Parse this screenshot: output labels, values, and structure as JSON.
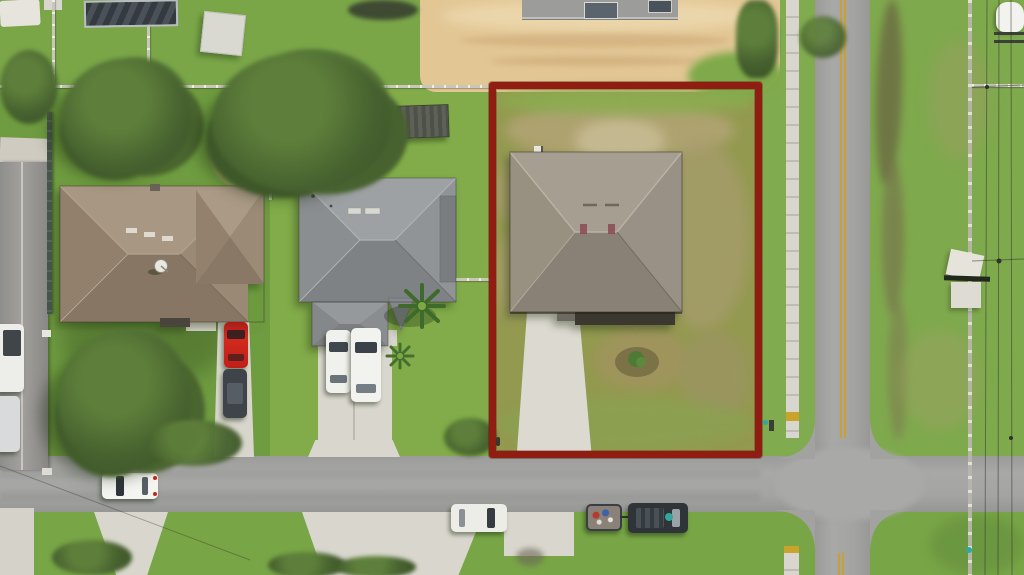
{
  "meta": {
    "image_type": "aerial-drone-photograph",
    "subject": "residential lot outlined for real estate listing",
    "width_px": 1024,
    "height_px": 575,
    "visible_text": "none"
  },
  "boundary": {
    "label": "property boundary outline",
    "color": "#8F1D12",
    "shape": "rectangle"
  },
  "palette": {
    "asphalt": "#A2A2A0",
    "concrete": "#D9D7CD",
    "sand_lot": "#E2C694",
    "grass_bright": "#82AC49",
    "grass_mid": "#6F9C40",
    "grass_dry_patch": "#AC9E72",
    "tree_canopy": "#46612E",
    "center_line_yellow": "#C9A035",
    "roof_subject": "#9A9186",
    "roof_middle": "#909294",
    "roof_left": "#9A8974",
    "red_car": "#C2241C",
    "dark_truck": "#2E3438"
  },
  "scene": {
    "houses": [
      {
        "name": "subject house",
        "desc": "gray hip roof inside red boundary, concrete driveway, shrub in yard, patchy dry lawn"
      },
      {
        "name": "middle house",
        "desc": "gray hip roof, two white cars on driveway, palm trees, dark shed in backyard"
      },
      {
        "name": "left house",
        "desc": "brown hip roof, satellite dish, red car and dark car on driveway, large oak trees"
      },
      {
        "name": "construction house",
        "desc": "house under construction on sand lot at top"
      }
    ],
    "roads": [
      {
        "name": "vertical street",
        "marking": "double yellow center line"
      },
      {
        "name": "horizontal street",
        "marking": "plain asphalt"
      },
      {
        "name": "intersection",
        "desc": "four-way crossing bottom right"
      }
    ],
    "vehicles": [
      {
        "name": "red car",
        "location": "left house driveway"
      },
      {
        "name": "dark car",
        "location": "left house driveway"
      },
      {
        "name": "white car",
        "location": "middle house driveway"
      },
      {
        "name": "white suv",
        "location": "middle house driveway"
      },
      {
        "name": "white vehicle driving",
        "location": "horizontal street"
      },
      {
        "name": "parked white suv",
        "location": "south roadside"
      },
      {
        "name": "pickup truck with utility trailer",
        "location": "south roadside"
      },
      {
        "name": "covered boat on trailer",
        "location": "top right corner"
      }
    ],
    "infrastructure": [
      "sidewalk with curb ramps",
      "power lines",
      "white pvc fences",
      "dark fence",
      "drainage ditch",
      "mailbox",
      "utility markers"
    ],
    "vegetation": [
      "oak canopies",
      "palm trees",
      "shrub with mulch ring",
      "debris patch",
      "brown lawn patches"
    ]
  }
}
